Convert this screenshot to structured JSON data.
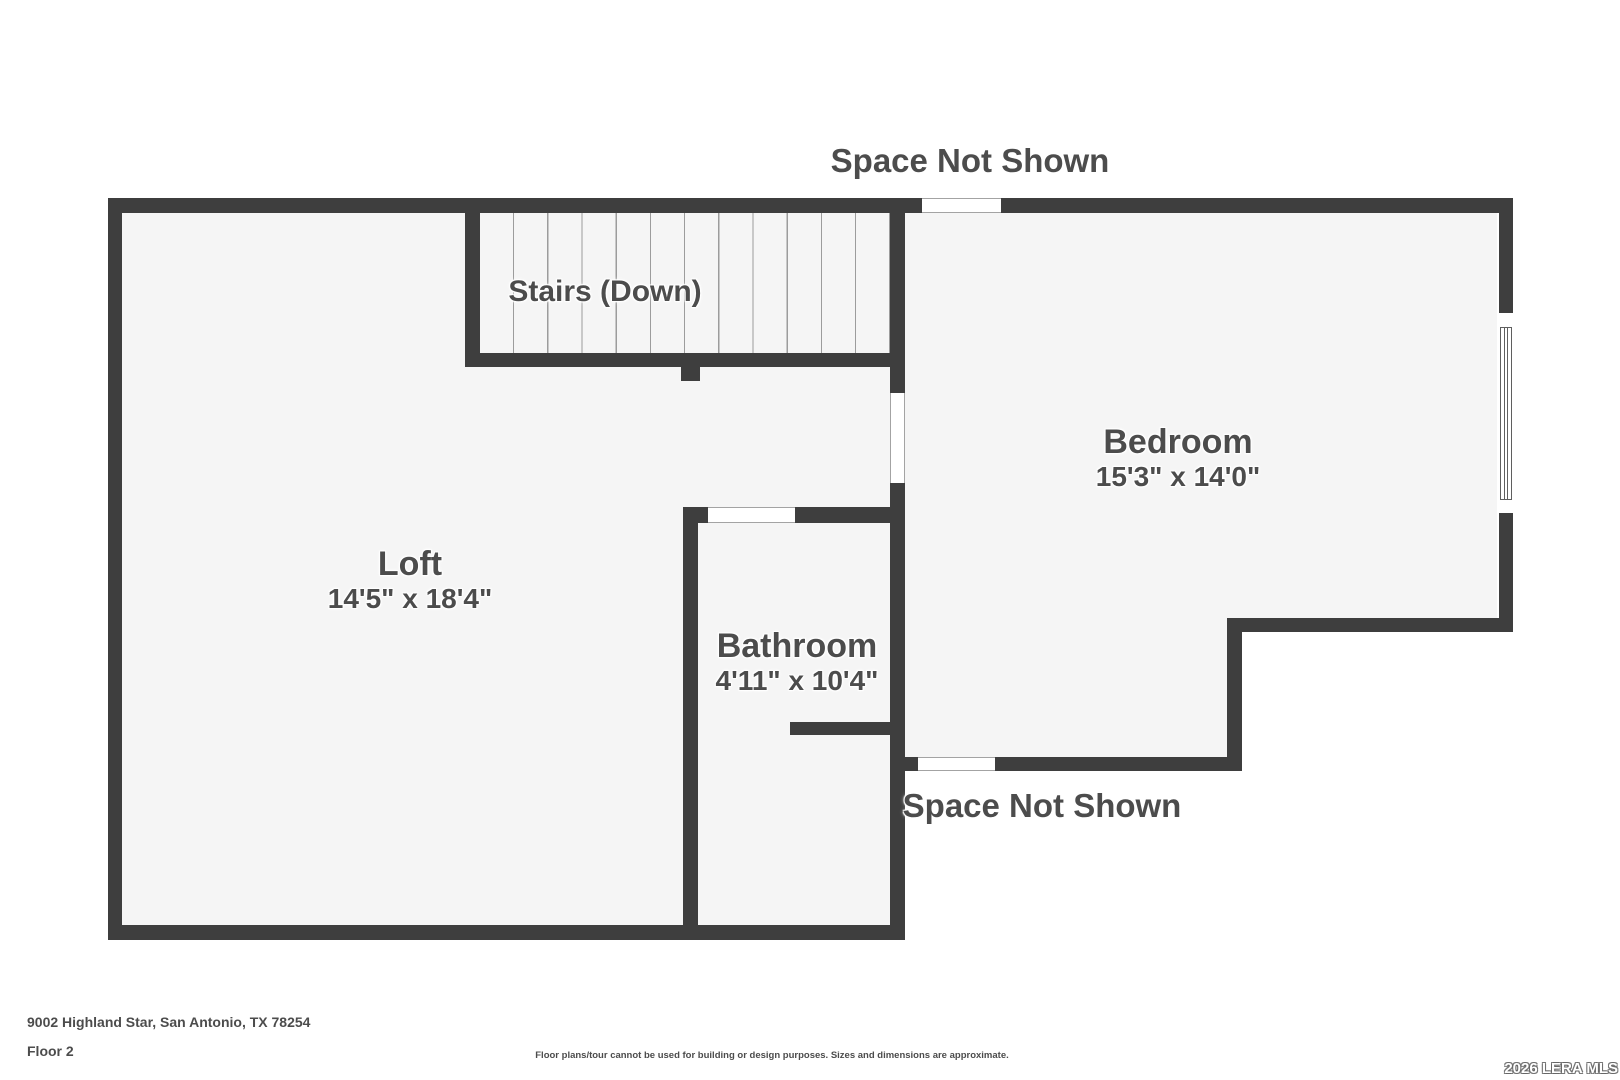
{
  "floorplan": {
    "space_not_shown_top": "Space Not Shown",
    "space_not_shown_bottom": "Space Not Shown",
    "stairs_label": "Stairs (Down)",
    "rooms": [
      {
        "name": "Loft",
        "dims": "14'5\" x 18'4\""
      },
      {
        "name": "Bedroom",
        "dims": "15'3\" x 14'0\""
      },
      {
        "name": "Bathroom",
        "dims": "4'11\" x 10'4\""
      }
    ],
    "colors": {
      "wall": "#3e3e3e",
      "room_fill": "#f5f5f5",
      "label_text": "#4c4c4c"
    }
  },
  "footer": {
    "address": "9002 Highland Star, San Antonio, TX 78254",
    "floor": "Floor 2",
    "disclaimer": "Floor plans/tour cannot be used for building or design purposes. Sizes and dimensions are approximate.",
    "watermark": "2026 LERA MLS"
  }
}
